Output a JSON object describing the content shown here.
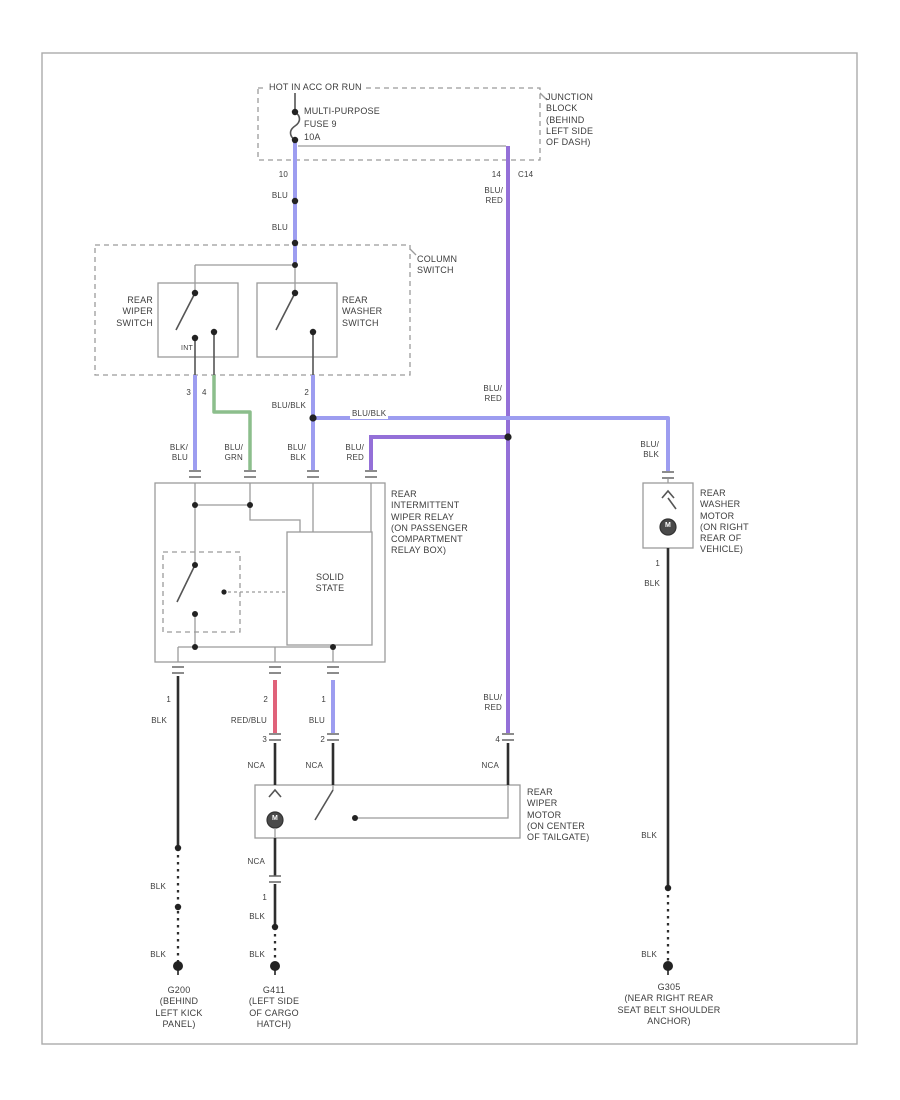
{
  "colors": {
    "blu": "#9d9df0",
    "purple": "#9470d8",
    "green": "#8cbe8c",
    "red": "#e0627a",
    "wireblack": "#2e2e2e",
    "linegray": "#9b9b9b",
    "text": "#3d3d3d"
  },
  "header": {
    "power_note": "HOT IN ACC OR RUN"
  },
  "junction_block": {
    "label": "JUNCTION\nBLOCK\n(BEHIND\nLEFT SIDE\nOF DASH)",
    "fuse_name": "MULTI-PURPOSE",
    "fuse_id": "FUSE 9",
    "fuse_rating": "10A",
    "pin_left": "10",
    "pin_right": "14",
    "connector": "C14"
  },
  "column_switch": {
    "label": "COLUMN\nSWITCH",
    "wiper_label": "REAR\nWIPER\nSWITCH",
    "washer_label": "REAR\nWASHER\nSWITCH",
    "int_label": "INT",
    "pin_wiper_a": "3",
    "pin_wiper_b": "4",
    "pin_washer": "2"
  },
  "wire_labels": {
    "blu": "BLU",
    "blu_red": "BLU/\nRED",
    "blk_blu": "BLK/\nBLU",
    "blu_grn": "BLU/\nGRN",
    "blu_blk": "BLU/\nBLK",
    "blu_blk_1line": "BLU/BLK",
    "red_blu": "RED/BLU",
    "blk": "BLK",
    "nca": "NCA"
  },
  "relay": {
    "label": "REAR\nINTERMITTENT\nWIPER RELAY\n(ON PASSENGER\nCOMPARTMENT\nRELAY BOX)",
    "solid_state": "SOLID\nSTATE",
    "pin_out_left": "1",
    "pin_out_mid": "2",
    "pin_out_right": "1"
  },
  "wiper_motor": {
    "label": "REAR\nWIPER\nMOTOR\n(ON CENTER\nOF TAILGATE)",
    "motor_letter": "M",
    "pin_in_left": "3",
    "pin_in_mid": "2",
    "pin_in_right": "4",
    "pin_out": "1"
  },
  "washer_motor": {
    "label": "REAR\nWASHER\nMOTOR\n(ON RIGHT\nREAR OF\nVEHICLE)",
    "motor_letter": "M",
    "pin": "1"
  },
  "grounds": {
    "left": "G200\n(BEHIND\nLEFT KICK\nPANEL)",
    "mid": "G411\n(LEFT SIDE\nOF CARGO\nHATCH)",
    "right": "G305\n(NEAR RIGHT REAR\nSEAT BELT SHOULDER\nANCHOR)"
  }
}
